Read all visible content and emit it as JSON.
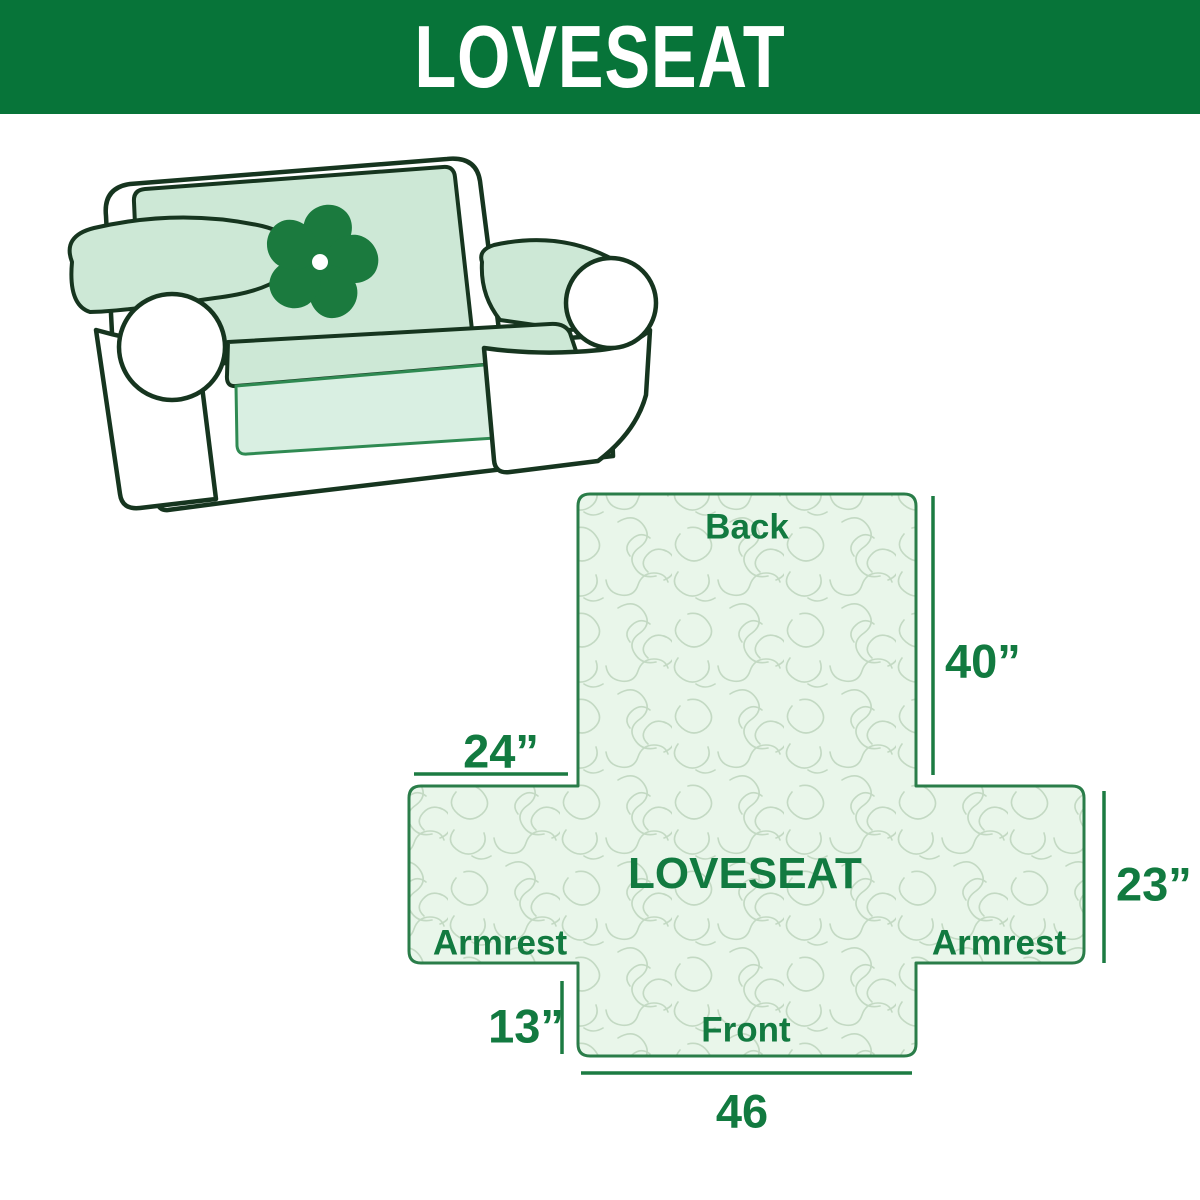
{
  "header": {
    "title": "LOVESEAT"
  },
  "colors": {
    "banner_green": "#077439",
    "label_green": "#127a40",
    "dimension_line_green": "#1c7b42",
    "diagram_border_green": "#2a7d49",
    "diagram_fill": "#e9f6ea",
    "quilt_pattern_line": "#c3d9c3",
    "cover_mint": "#cde8d6",
    "skirt_mint": "#d9efe2",
    "sofa_outline": "#16351f",
    "logo_green": "#1b7a3e"
  },
  "illustration": {
    "description": "Loveseat sofa wearing a mint quilted slipcover",
    "logo_icon": "pinwheel-icon"
  },
  "diagram": {
    "center_label": "LOVESEAT",
    "back_label": "Back",
    "front_label": "Front",
    "armrest_left_label": "Armrest",
    "armrest_right_label": "Armrest",
    "dim_back_height": "40”",
    "dim_armrest_top_width": "24”",
    "dim_armrest_side_height": "23”",
    "dim_front_skirt_height": "13”",
    "dim_front_width": "46"
  }
}
